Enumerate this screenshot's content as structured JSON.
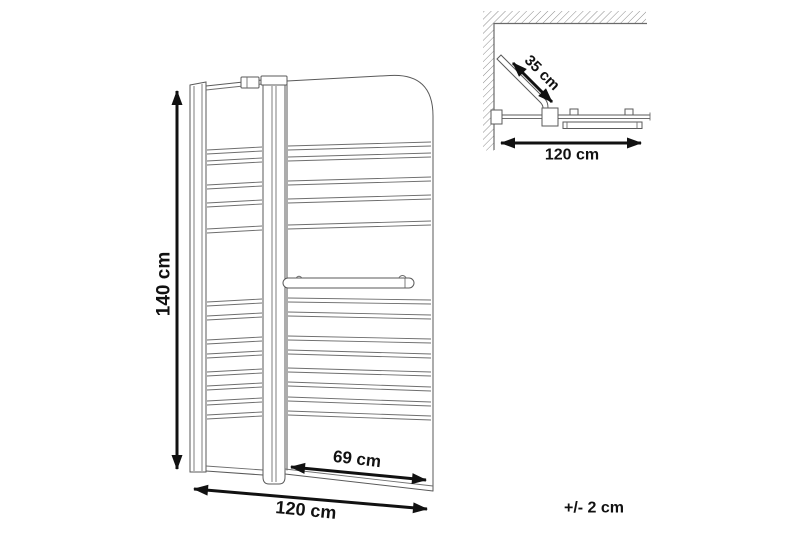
{
  "diagram": {
    "description": "Bathtub shower screen dimension drawing, front view and top view",
    "front_view": {
      "height_label": "140 cm",
      "width_label": "120 cm",
      "door_width_label": "69 cm"
    },
    "top_view": {
      "swing_label": "35 cm",
      "width_label": "120 cm"
    },
    "tolerance_label": "+/- 2 cm",
    "colors": {
      "background": "#ffffff",
      "outline": "#5a5a5a",
      "stripe": "#6e6e6e",
      "dimension": "#111111",
      "hatch": "#8c8c8c"
    }
  }
}
